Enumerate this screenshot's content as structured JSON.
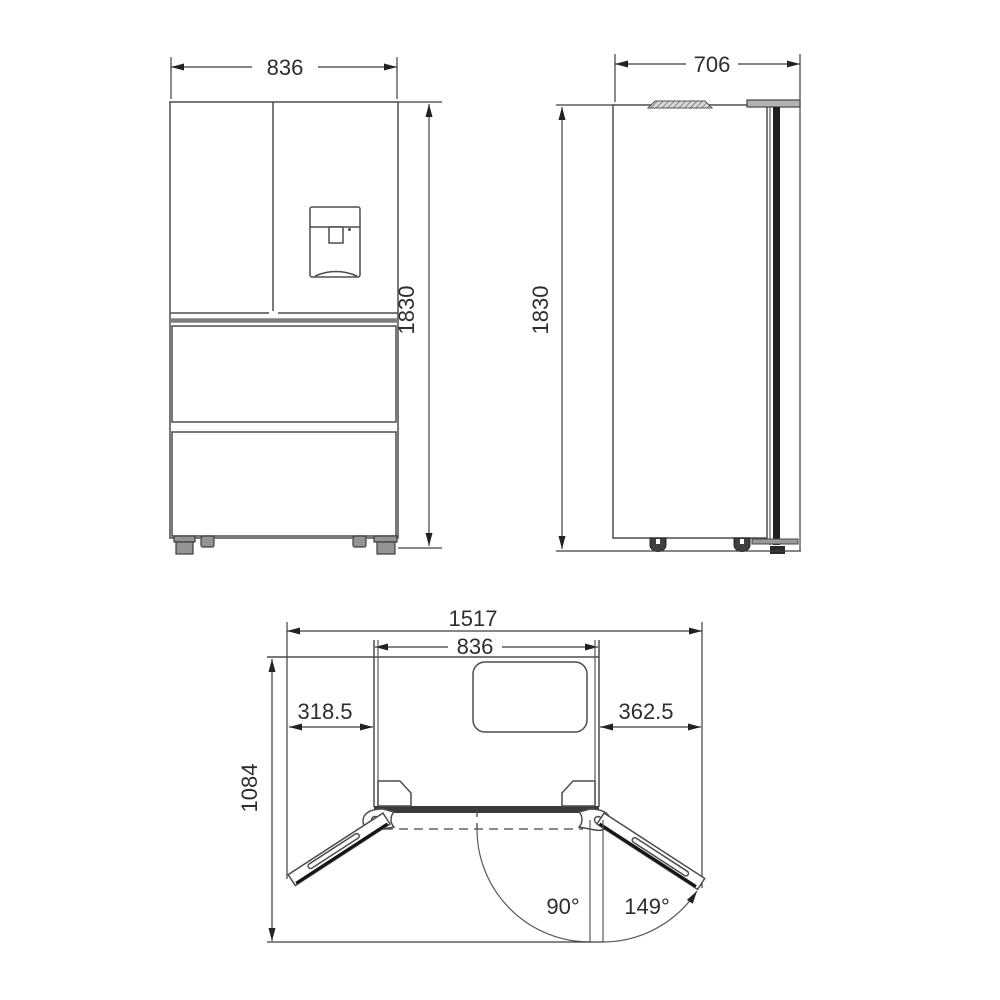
{
  "diagram": {
    "front_view": {
      "width_mm": "836",
      "height_mm": "1830"
    },
    "side_view": {
      "depth_mm": "706",
      "height_mm": "1830"
    },
    "top_view": {
      "overall_width_mm": "1517",
      "cabinet_width_mm": "836",
      "left_door_projection_mm": "318.5",
      "right_door_projection_mm": "362.5",
      "depth_doors_open_mm": "1084",
      "left_door_open_angle": "90°",
      "right_door_open_angle": "149°"
    },
    "colors": {
      "line": "#4d4d4d",
      "dark": "#161616",
      "gray_fill": "#949494",
      "background": "#ffffff"
    }
  }
}
